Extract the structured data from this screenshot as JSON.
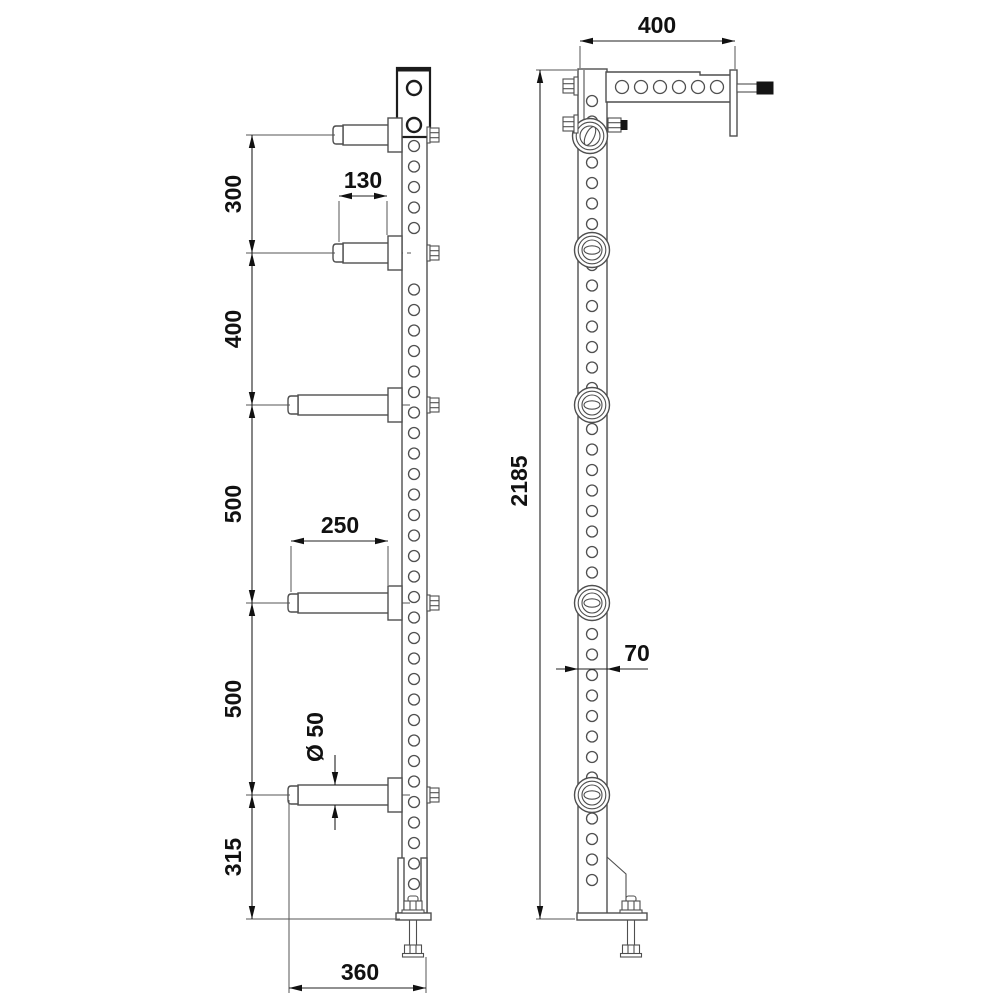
{
  "drawing": {
    "type": "technical-2-view-drawing",
    "colors": {
      "background": "#ffffff",
      "part_line": "#4f4f4f",
      "bold_line": "#1c1c1c",
      "dimension_line": "#222222",
      "text": "#111111",
      "pin_fill": "#141414"
    },
    "front_view": {
      "post": {
        "x": 402,
        "y": 69,
        "w": 25,
        "h": 846
      },
      "top_plate": {
        "x": 397,
        "y": 68,
        "w": 33,
        "h": 69,
        "hole_ys": [
          88,
          125
        ],
        "hole_r": 7
      },
      "holes": {
        "cx": 414,
        "r": 5.5,
        "y_start": 146,
        "step": 20.5,
        "y_end": 888,
        "skip_ranges": [
          [
            235,
            272
          ]
        ]
      },
      "pegs": [
        {
          "y": 135,
          "tip": 333,
          "front_of_plate": true
        },
        {
          "y": 253,
          "tip": 333
        },
        {
          "y": 405,
          "tip": 288
        },
        {
          "y": 603,
          "tip": 288
        },
        {
          "y": 795,
          "tip": 288
        }
      ],
      "peg_profile": {
        "cap_w": 10,
        "cyl_half": 10,
        "base_x": 388,
        "base_w": 14,
        "base_half": 17,
        "centerline_end": 412
      },
      "gussets": [
        {
          "x": 398,
          "y": 858,
          "w": 6,
          "h": 55
        },
        {
          "x": 421,
          "y": 858,
          "w": 6,
          "h": 55
        }
      ],
      "foot": {
        "plate": {
          "x": 396,
          "y": 913,
          "w": 35,
          "h": 7
        },
        "bolt_cx": 413
      }
    },
    "side_view": {
      "post": {
        "x": 578,
        "y": 69,
        "w": 29,
        "h": 846
      },
      "front_strip_x": 584,
      "holes": {
        "cx": 592,
        "r": 5.5,
        "y_start": 101,
        "step": 20.5,
        "y_end": 888,
        "skip_ranges": []
      },
      "arm": {
        "x1": 606,
        "x2": 731,
        "top": 72,
        "step_x": 700,
        "step_top": 75,
        "bottom": 102,
        "holes": {
          "y": 87,
          "r": 6.5,
          "xs": [
            622,
            641,
            660,
            679,
            698,
            717
          ]
        }
      },
      "wall_plate": {
        "x": 730,
        "y": 70,
        "w": 7,
        "h": 66
      },
      "pin": {
        "shaft": {
          "x": 737,
          "y": 84,
          "w": 21,
          "h": 8
        },
        "head": {
          "x": 757,
          "y": 82,
          "w": 16,
          "h": 12
        }
      },
      "collars": [
        {
          "cx": 590,
          "cy": 136,
          "type": "slot"
        },
        {
          "cx": 592,
          "cy": 250,
          "type": "oval"
        },
        {
          "cx": 592,
          "cy": 405,
          "type": "oval"
        },
        {
          "cx": 592,
          "cy": 603,
          "type": "oval"
        },
        {
          "cx": 592,
          "cy": 795,
          "type": "oval"
        }
      ],
      "collar_profile": {
        "r_outer": 17.5,
        "r_ring": 13.8,
        "r_inner": 10,
        "oval_rx": 8,
        "oval_ry": 4.2,
        "slot_rx": 4.2,
        "slot_ry": 10,
        "slot_rot": 25
      },
      "side_bolts_y": [
        86,
        124
      ],
      "collar_nut": {
        "x": 608,
        "y": 118,
        "w": 13,
        "h": 14,
        "black_x": 621,
        "black_y": 120.5,
        "black_w": 6,
        "black_h": 9
      },
      "foot": {
        "gusset": [
          [
            607,
            857
          ],
          [
            626,
            874
          ],
          [
            626,
            914
          ]
        ],
        "plate": {
          "x": 577,
          "y": 913,
          "w": 70,
          "h": 7
        },
        "bolt_cx": 631
      }
    },
    "dims": [
      {
        "id": "arm-length",
        "label": "400",
        "type": "linear",
        "orient": "h",
        "arrows": "in",
        "line": {
          "y": 41,
          "x1": 580,
          "x2": 735
        },
        "text": {
          "x": 657,
          "y": 33,
          "rotated": false
        },
        "ext": [
          [
            580,
            46,
            580,
            68
          ],
          [
            735,
            46,
            735,
            69
          ]
        ],
        "tails": []
      },
      {
        "id": "total-height",
        "label": "2185",
        "type": "linear",
        "orient": "v",
        "arrows": "in",
        "line": {
          "x": 540,
          "y1": 70,
          "y2": 919
        },
        "text": {
          "x": 527,
          "y": 481,
          "rotated": true
        },
        "ext": [
          [
            536,
            70,
            577,
            70
          ],
          [
            536,
            919,
            575,
            919
          ]
        ],
        "tails": []
      },
      {
        "id": "peg-spacing-chain",
        "type": "chain",
        "orient": "v",
        "x": 252,
        "stops": [
          135,
          253,
          405,
          603,
          795,
          919
        ],
        "labels": [
          "300",
          "400",
          "500",
          "500",
          "315"
        ],
        "text_x": 241,
        "ext": [
          [
            246,
            135,
            335,
            135
          ],
          [
            246,
            253,
            335,
            253
          ],
          [
            246,
            405,
            290,
            405
          ],
          [
            246,
            603,
            290,
            603
          ],
          [
            246,
            795,
            290,
            795
          ],
          [
            246,
            919,
            400,
            919
          ]
        ]
      },
      {
        "id": "short-peg-length",
        "label": "130",
        "type": "linear",
        "orient": "h",
        "arrows": "in",
        "line": {
          "y": 196,
          "x1": 339,
          "x2": 387
        },
        "text": {
          "x": 363,
          "y": 188,
          "rotated": false
        },
        "ext": [
          [
            339,
            201,
            339,
            242
          ],
          [
            387,
            201,
            387,
            235
          ]
        ],
        "tails": []
      },
      {
        "id": "long-peg-length",
        "label": "250",
        "type": "linear",
        "orient": "h",
        "arrows": "in",
        "line": {
          "y": 541,
          "x1": 291,
          "x2": 388
        },
        "text": {
          "x": 340,
          "y": 533,
          "rotated": false
        },
        "ext": [
          [
            291,
            546,
            291,
            592
          ],
          [
            388,
            546,
            388,
            585
          ]
        ],
        "tails": []
      },
      {
        "id": "base-depth",
        "label": "360",
        "type": "linear",
        "orient": "h",
        "arrows": "in",
        "line": {
          "y": 988,
          "x1": 289,
          "x2": 426
        },
        "text": {
          "x": 360,
          "y": 980,
          "rotated": false
        },
        "ext": [
          [
            289,
            800,
            289,
            993
          ],
          [
            426,
            957,
            426,
            993
          ]
        ],
        "tails": []
      },
      {
        "id": "post-width",
        "label": "70",
        "type": "linear",
        "orient": "h",
        "arrows": "out",
        "line": {
          "y": 669,
          "x1": 578,
          "x2": 607
        },
        "text": {
          "x": 637,
          "y": 661,
          "rotated": false
        },
        "ext": [],
        "tails": [
          [
            556,
            669,
            578,
            669
          ],
          [
            607,
            669,
            648,
            669
          ]
        ]
      },
      {
        "id": "peg-diameter",
        "label": "Ø 50",
        "type": "linear",
        "orient": "v",
        "arrows": "out",
        "line": {
          "x": 335,
          "y1": 785,
          "y2": 805
        },
        "text": {
          "x": 323,
          "y": 737,
          "rotated": true
        },
        "ext": [],
        "tails": [
          [
            335,
            755,
            335,
            785
          ],
          [
            335,
            805,
            335,
            830
          ]
        ]
      }
    ]
  }
}
